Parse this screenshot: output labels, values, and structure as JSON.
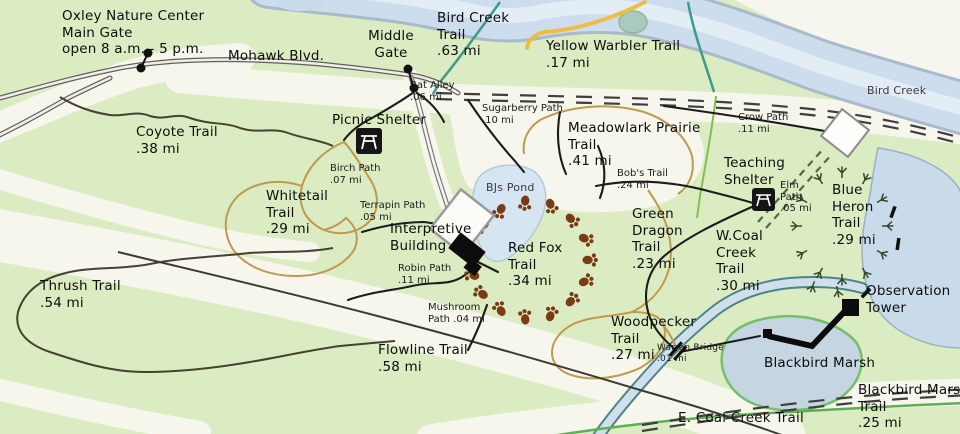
{
  "colors": {
    "map_green": "#dcecc2",
    "open_field_white": "#f6f6ec",
    "water_blue": "#cddded",
    "water_border": "#a9bacb",
    "road_gray": "#5f5f5f",
    "trail_black": "#1c1c1c",
    "trail_tan": "#bf9a4e",
    "trail_yellow": "#f0bc44",
    "trail_teal": "#3e9a8a",
    "trail_green": "#5fae53",
    "paw_brown": "#7a3a14",
    "heron_track_green": "#2f4a2a",
    "building_black": "#0d0d0d"
  },
  "labels": {
    "oxley_main_gate": "Oxley Nature Center\nMain Gate\nopen 8 a.m. - 5 p.m.",
    "mohawk_blvd": "Mohawk Blvd.",
    "middle_gate": "Middle\nGate",
    "bird_creek_trail": "Bird Creek\nTrail\n.63 mi",
    "yellow_warbler": "Yellow Warbler Trail\n.17 mi",
    "bird_creek_river": "Bird Creek",
    "bat_alley": "Bat Alley\n.06 mi",
    "sugarberry": "Sugarberry Path\n.10 mi",
    "meadowlark": "Meadowlark Prairie\nTrail\n.41 mi",
    "crow_path": "Crow Path\n.11 mi",
    "picnic_shelter": "Picnic Shelter",
    "coyote": "Coyote Trail\n.38 mi",
    "birch_path": "Birch Path\n.07 mi",
    "whitetail": "Whitetail\nTrail\n.29 mi",
    "terrapin": "Terrapin Path\n.05 mi",
    "bjs_pond": "BJs Pond",
    "bobs_trail": "Bob's Trail\n.24 mi",
    "teaching_shelter": "Teaching\nShelter",
    "elm_path": "Elm\nPath\n.05 mi",
    "blue_heron": "Blue\nHeron\nTrail\n.29 mi",
    "interpretive": "Interpretive\nBuilding",
    "red_fox": "Red Fox\nTrail\n.34 mi",
    "green_dragon": "Green\nDragon\nTrail\n.23 mi",
    "w_coal": "W.Coal\nCreek\nTrail\n.30 mi",
    "robin_path": "Robin Path\n.11 mi",
    "thrush": "Thrush Trail\n.54 mi",
    "mushroom": "Mushroom\nPath .04 mi",
    "woodpecker": "Woodpecker\nTrail\n.27 mi",
    "warren_bridge": "Warren Bridge\n.01 mi",
    "observation_tower": "Observation\nTower",
    "flowline": "Flowline Trail\n.58 mi",
    "blackbird_marsh": "Blackbird Marsh",
    "blackbird_marsh_trail": "Blackbird Marsh Trail\n.25 mi",
    "e_coal_creek": "E. Coal Creek Trail"
  }
}
